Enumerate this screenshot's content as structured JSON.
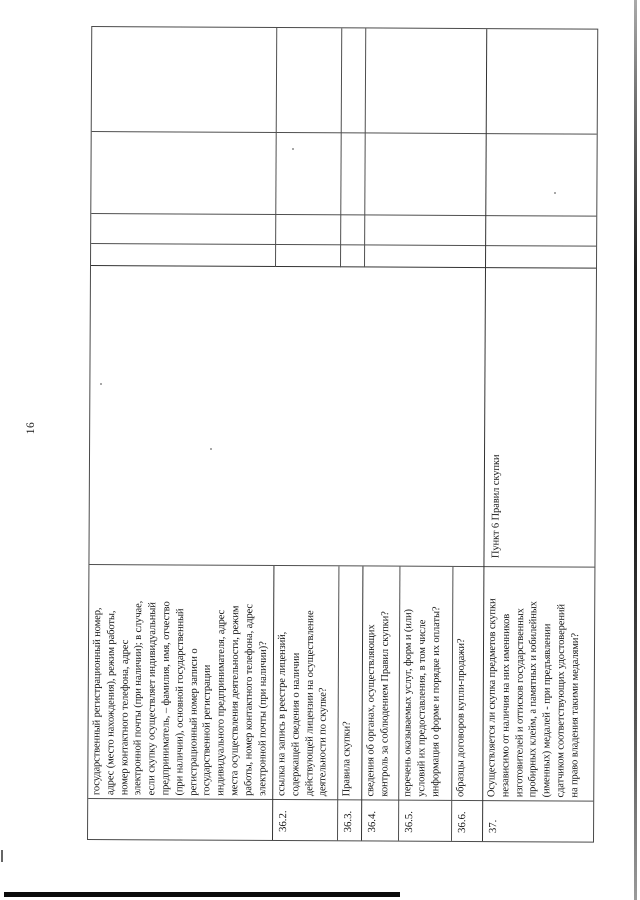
{
  "page": {
    "number": "16"
  },
  "colors": {
    "ink": "#161616",
    "grid": "#4f4f4f",
    "scan_edge": "#0b0b0b"
  },
  "table": {
    "rows": [
      {
        "num": "",
        "question": "государственный регистрационный номер,\nадрес (место нахождения), режим работы,\nномер контактного телефона, адрес\nэлектронной почты (при наличии); в случае,\nесли скупку осуществляет индивидуальный\nпредприниматель, – фамилия, имя, отчество\n(при наличии), основной государственный\nрегистрационный номер записи о\nгосударственной регистрации\nиндивидуального предпринимателя, адрес\nместа осуществления деятельности, режим\nработы, номер контактного телефона, адрес\nэлектронной почты (при наличии)?",
        "reference": ""
      },
      {
        "num": "36.2.",
        "question": "ссылка на запись в реестре лицензий,\nсодержащей сведения о наличии\nдействующей лицензии на осуществление\nдеятельности по скупке?",
        "reference": ""
      },
      {
        "num": "36.3.",
        "question": "Правила скупки?",
        "reference": ""
      },
      {
        "num": "36.4.",
        "question": "сведения об органах, осуществляющих\nконтроль за соблюдением Правил скупки?",
        "reference": ""
      },
      {
        "num": "36.5.",
        "question": "перечень оказываемых услуг, форм и (или)\nусловий их предоставления, в том числе\nинформация о форме и порядке их оплаты?",
        "reference": ""
      },
      {
        "num": "36.6.",
        "question": "образцы договоров купли-продажи?",
        "reference": ""
      },
      {
        "num": "37.",
        "question": "Осуществляется ли скупка предметов скупки\nнезависимо от наличия на них именников\nизготовителей и оттисков государственных\nпробирных клейм, а памятных и юбилейных\n(именных) медалей - при предъявлении\nсдатчиком соответствующих удостоверений\nна право владения такими медалями?",
        "reference": "Пункт 6 Правил скупки"
      }
    ]
  }
}
